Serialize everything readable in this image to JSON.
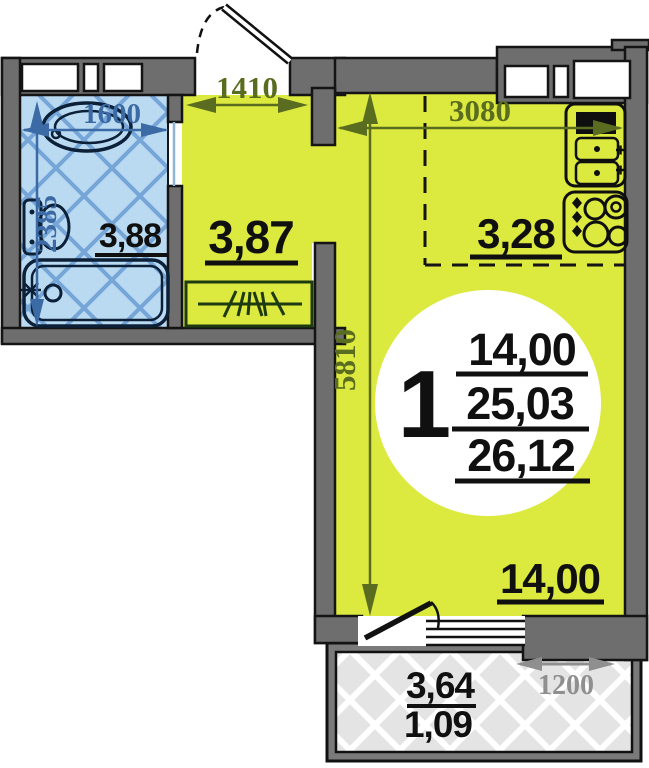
{
  "plan": {
    "title": "studio-apartment-floor-plan",
    "unit_badge": {
      "rooms": "1",
      "living_area": "14,00",
      "total_area": "25,03",
      "total_with_balcony": "26,12"
    },
    "rooms": {
      "bathroom": {
        "area": "3,88"
      },
      "hall": {
        "area": "3,87"
      },
      "kitchen": {
        "area": "3,28"
      },
      "living_room": {
        "area": "14,00"
      },
      "balcony": {
        "area": "3,64",
        "reduced_area": "1,09"
      }
    },
    "dimensions_mm": {
      "entry_opening": "1410",
      "kitchen_width": "3080",
      "bathroom_width": "1600",
      "bathroom_depth": "2385",
      "room_length": "5810",
      "balcony_width": "1200"
    },
    "colors": {
      "room_fill": "#dce93e",
      "wall_fill": "#6e6e6e",
      "wall_stroke": "#141414",
      "bathroom_fill": "#badaf2",
      "bathroom_hatch": "#76a5d8",
      "balcony_fill": "#e4e4e4",
      "balcony_hatch": "#ffffff",
      "dimension_olive": "#5a6c1f",
      "dimension_blue": "#3b6aa5",
      "dimension_gray": "#8f8f8f",
      "label_color": "#101010"
    },
    "icons": {
      "bathtub": "bathtub-icon",
      "toilet": "toilet-icon",
      "washbasin": "washbasin-icon",
      "kitchen_sink": "kitchen-sink-icon",
      "stove": "stove-icon",
      "wardrobe": "wardrobe-icon"
    }
  }
}
